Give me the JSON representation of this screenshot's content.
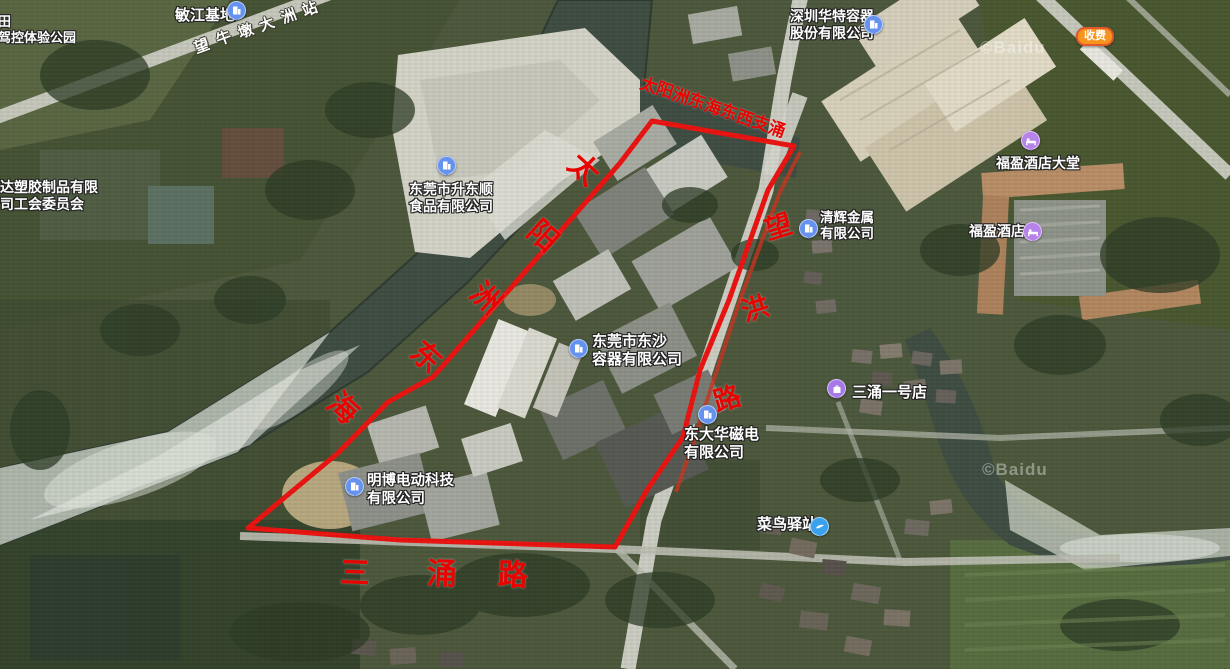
{
  "map": {
    "kind": "satellite-map-with-area-boundary",
    "boundary_color": "#ec1310"
  },
  "watermarks": {
    "first": "©Baidu",
    "second": "©Baidu"
  },
  "badges": {
    "toll": "收费"
  },
  "road_labels": {
    "station": {
      "text": "望牛墩大洲站",
      "chars": [
        "望",
        "牛",
        "墩",
        "大",
        "洲",
        "站"
      ]
    },
    "canal": {
      "text": "太阳洲东海东西支涌",
      "chars": [
        "太",
        "阳",
        "洲",
        "东",
        "海",
        "东",
        "西",
        "支",
        "涌"
      ]
    },
    "river": {
      "text": "太阳洲东海",
      "chars": [
        "太",
        "阳",
        "洲",
        "东",
        "海"
      ]
    },
    "wanghong": {
      "text": "望洪路",
      "chars": [
        "望",
        "洪",
        "路"
      ]
    },
    "sanchong": {
      "text": "三涌路",
      "chars": [
        "三",
        "涌",
        "路"
      ]
    }
  },
  "pois": {
    "minjiang": {
      "name": "敏江基地"
    },
    "park_fragment": {
      "line1": "田",
      "line2": "驾控体验公园"
    },
    "mingda": {
      "line1": "名达塑胶制品有限",
      "line2": "公司工会委员会"
    },
    "shengdongshun": {
      "line1": "东莞市升东顺",
      "line2": "食品有限公司"
    },
    "huate": {
      "line1": "深圳华特容器",
      "line2": "股份有限公司"
    },
    "qinghui": {
      "line1": "清辉金属",
      "line2": "有限公司"
    },
    "dongsha": {
      "line1": "东莞市东沙",
      "line2": "容器有限公司"
    },
    "sanchong_store": {
      "name": "三涌一号店"
    },
    "dongdahua": {
      "line1": "东大华磁电",
      "line2": "有限公司"
    },
    "mingbo": {
      "line1": "明博电动科技",
      "line2": "有限公司"
    },
    "cainiao": {
      "name": "菜鸟驿站"
    },
    "fuying_lobby": {
      "name": "福盈酒店大堂"
    },
    "fuying_hotel": {
      "name": "福盈酒店"
    }
  },
  "colors": {
    "poi_icon_blue": "#6592ee",
    "poi_icon_purple": "#b683ea",
    "cainiao_blue": "#3aa2ec",
    "red_label": "#e60300",
    "boundary": "#ec1310"
  }
}
